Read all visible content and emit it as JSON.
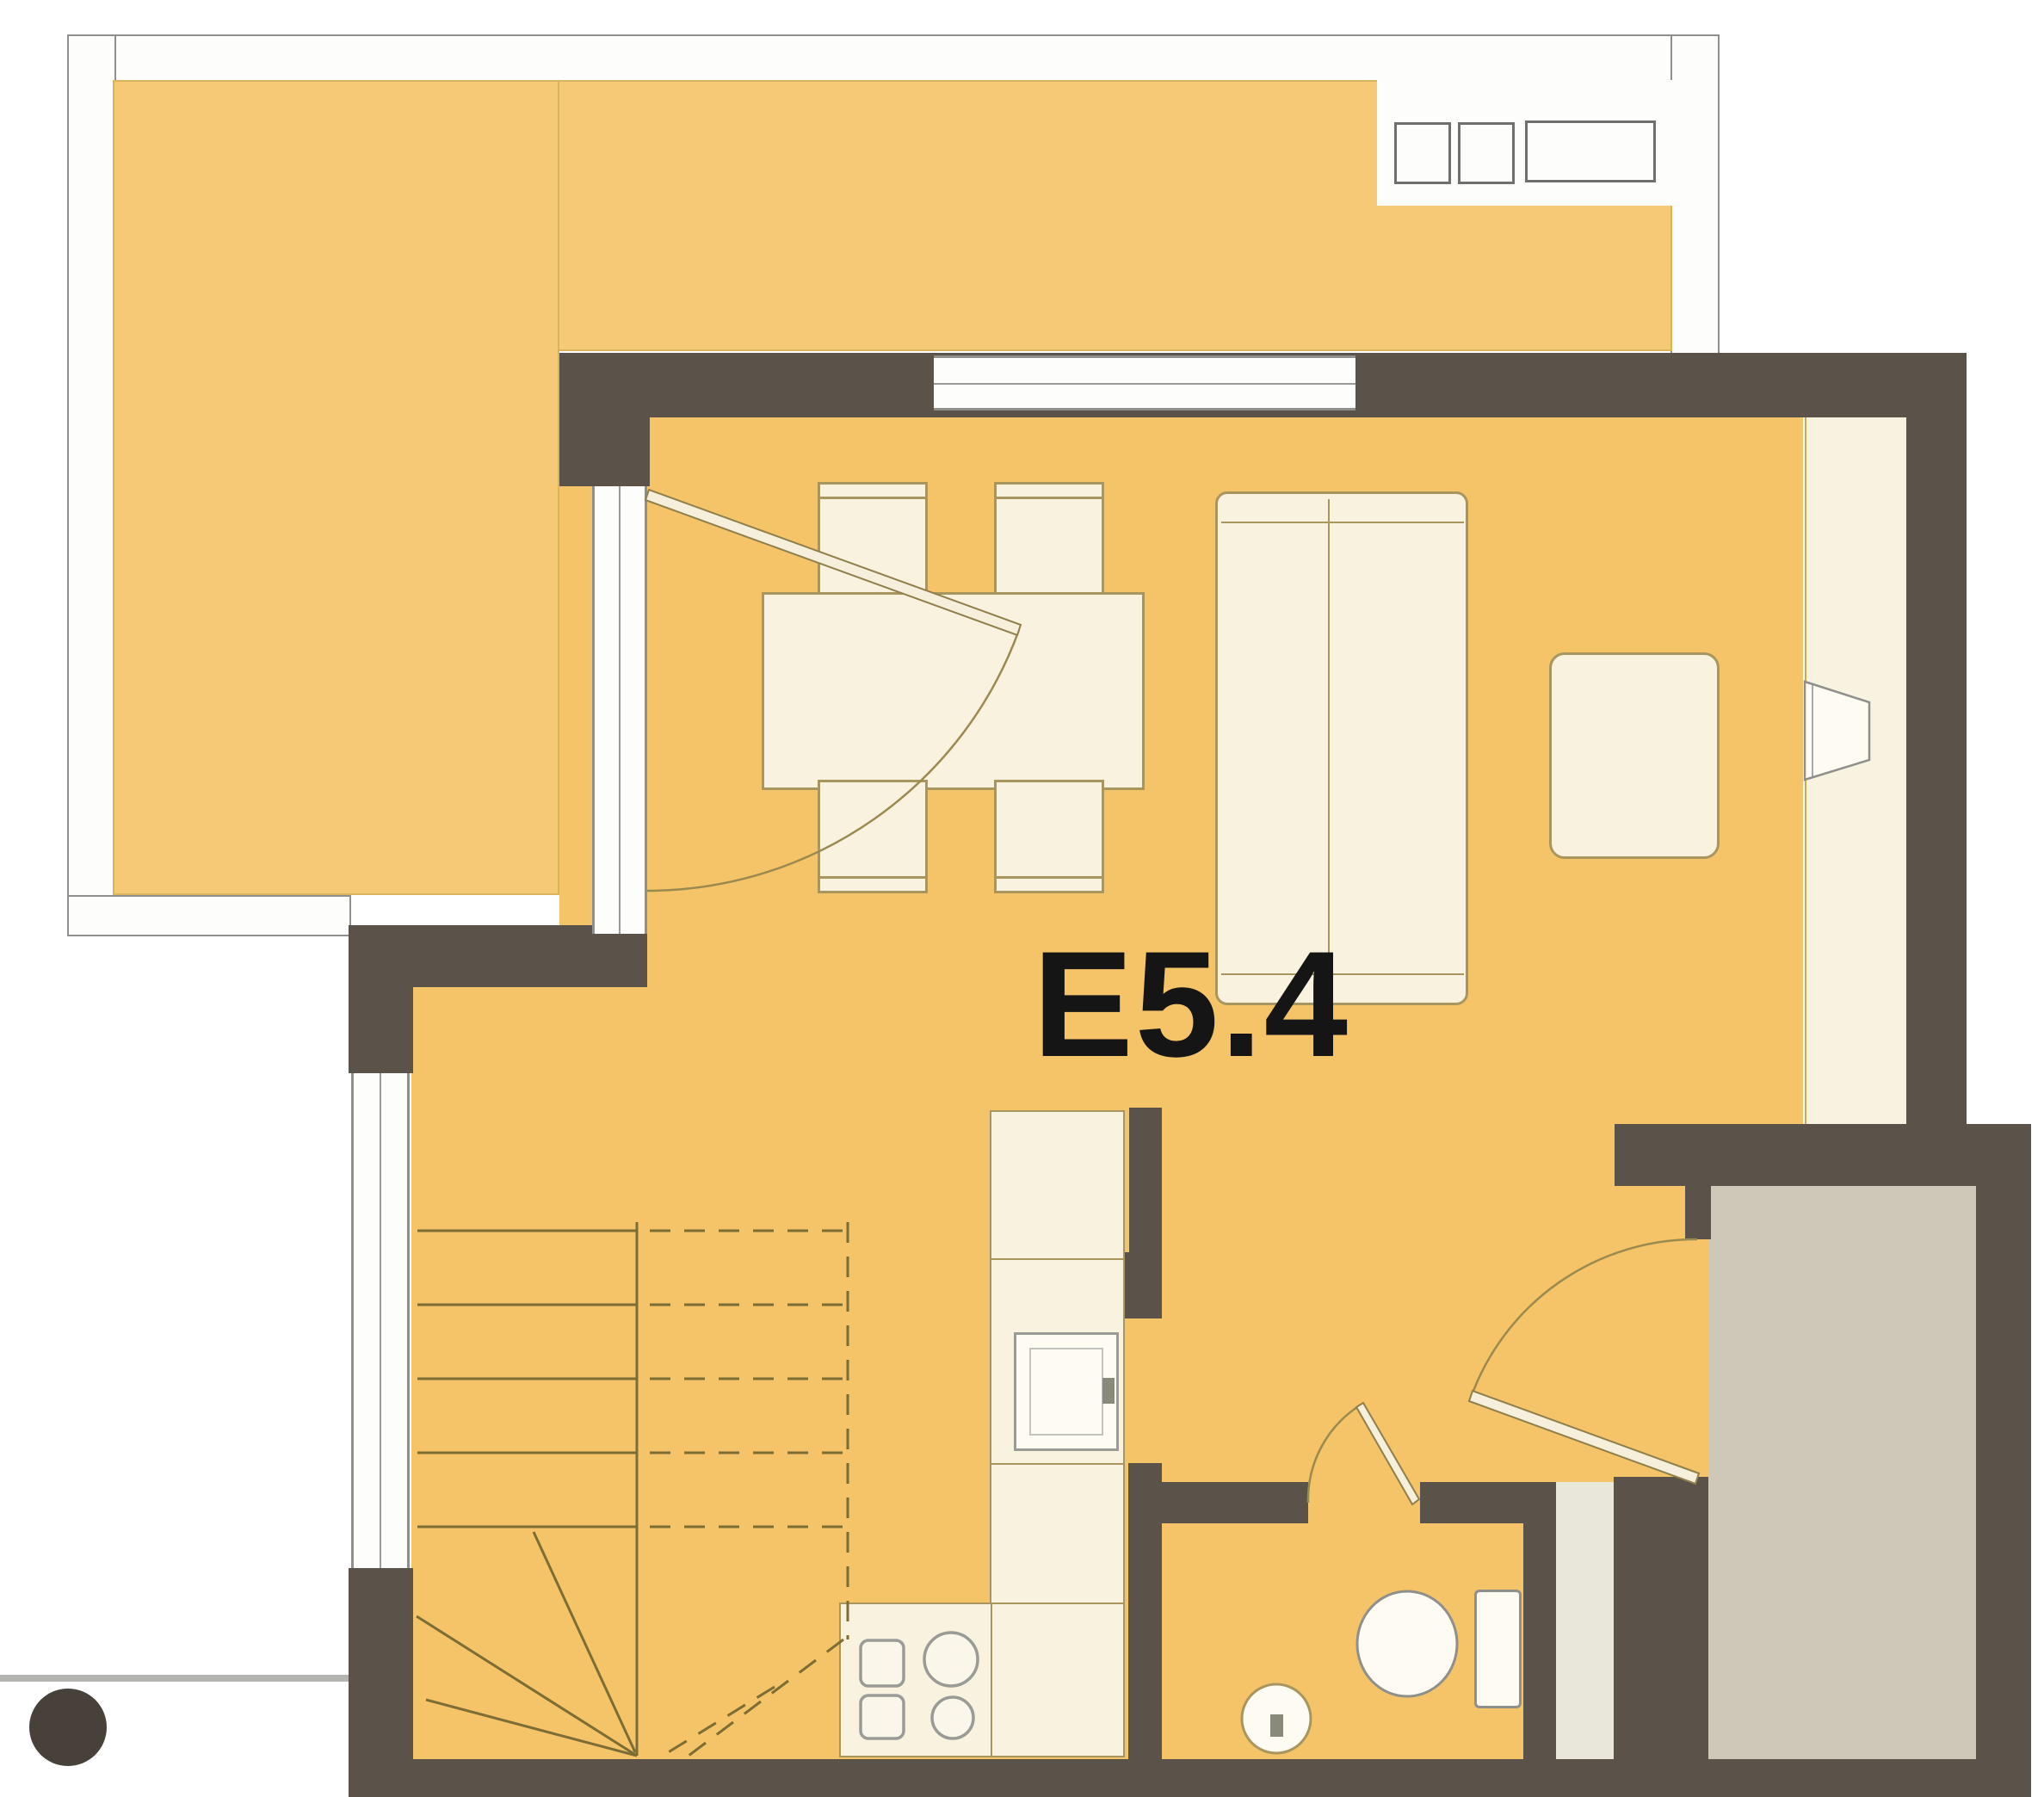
{
  "floor_plan": {
    "unit_label": "E5.4",
    "colors": {
      "floor": "#f5c468",
      "terrace_floor": "#f6ca74",
      "wall": "#5b5349",
      "furniture_fill": "#f9f2de",
      "furniture_outline": "#a8965e",
      "stair_line": "#7c6d35",
      "window_frame": "#8f8f8b",
      "landing_floor": "#cfc8b8",
      "label": "#151515"
    },
    "symbols": [
      {
        "name": "terrace-deck"
      },
      {
        "name": "terrace-planter"
      },
      {
        "name": "terrace-door-swing"
      },
      {
        "name": "dining-table"
      },
      {
        "name": "dining-chair",
        "count": 4
      },
      {
        "name": "sofa"
      },
      {
        "name": "side-table"
      },
      {
        "name": "wall-basin"
      },
      {
        "name": "staircase-with-winders"
      },
      {
        "name": "refrigerator"
      },
      {
        "name": "kitchen-sink"
      },
      {
        "name": "cooktop-burners",
        "count": 4
      },
      {
        "name": "bathroom-toilet"
      },
      {
        "name": "bathroom-washbasin"
      },
      {
        "name": "entry-door-swing"
      },
      {
        "name": "bathroom-door-swing"
      },
      {
        "name": "window",
        "count": 3
      },
      {
        "name": "exterior-column"
      }
    ]
  }
}
